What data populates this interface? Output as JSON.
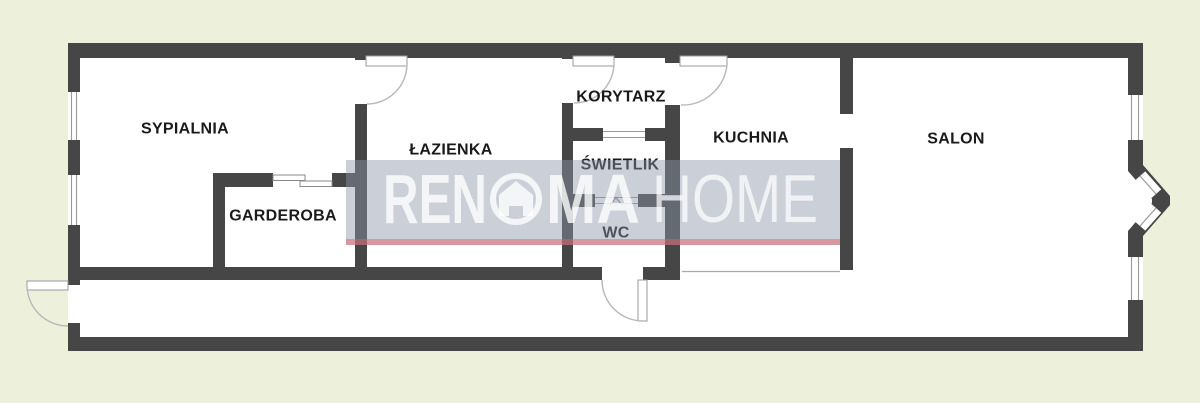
{
  "plan": {
    "background_color": "#edf0db",
    "wall_color": "#464646",
    "floor_color": "#ffffff",
    "rooms": [
      {
        "id": "sypialnia",
        "label": "SYPIALNIA"
      },
      {
        "id": "lazienka",
        "label": "ŁAZIENKA"
      },
      {
        "id": "korytarz",
        "label": "KORYTARZ"
      },
      {
        "id": "swietlik",
        "label": "ŚWIETLIK"
      },
      {
        "id": "kuchnia",
        "label": "KUCHNIA"
      },
      {
        "id": "salon",
        "label": "SALON"
      },
      {
        "id": "garderoba",
        "label": "GARDEROBA"
      },
      {
        "id": "wc",
        "label": "WC"
      }
    ]
  },
  "watermark": {
    "part1": "REN",
    "part2": "MA",
    "part3": "HOME",
    "logo": "house-in-circle-icon",
    "band_color": "rgba(140,148,168,0.45)",
    "accent_line_color": "rgba(225,95,100,0.5)",
    "text_color": "rgba(255,255,255,0.78)"
  }
}
